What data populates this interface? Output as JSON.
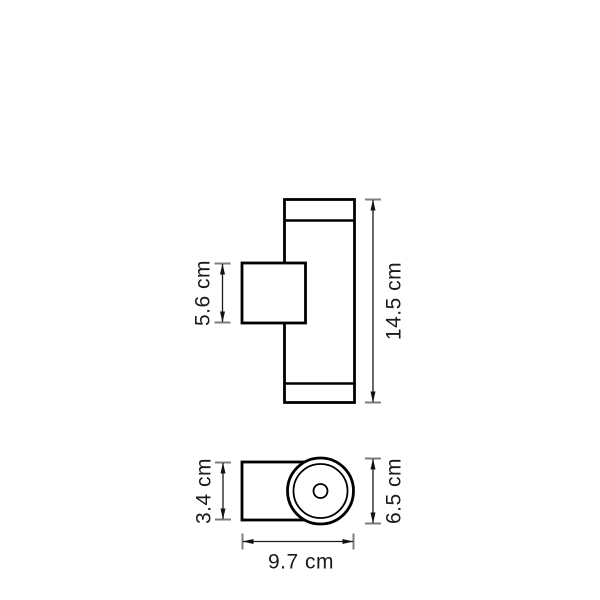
{
  "page": {
    "background_color": "#ffffff",
    "line_color": "#000000",
    "dim_line_color": "#1a1a1a",
    "dim_cap_color": "#7d7d7d",
    "text_color": "#1a1a1a"
  },
  "diagram": {
    "type": "technical-dimension-drawing",
    "subject": "cylindrical up-down wall light, front view and top view",
    "units": "cm",
    "views": {
      "front": {
        "labels": {
          "bracket_height": "5.6 cm",
          "overall_height": "14.5 cm"
        }
      },
      "top": {
        "labels": {
          "bracket_depth": "3.4 cm",
          "body_diameter": "6.5 cm",
          "overall_depth": "9.7 cm"
        }
      }
    }
  }
}
